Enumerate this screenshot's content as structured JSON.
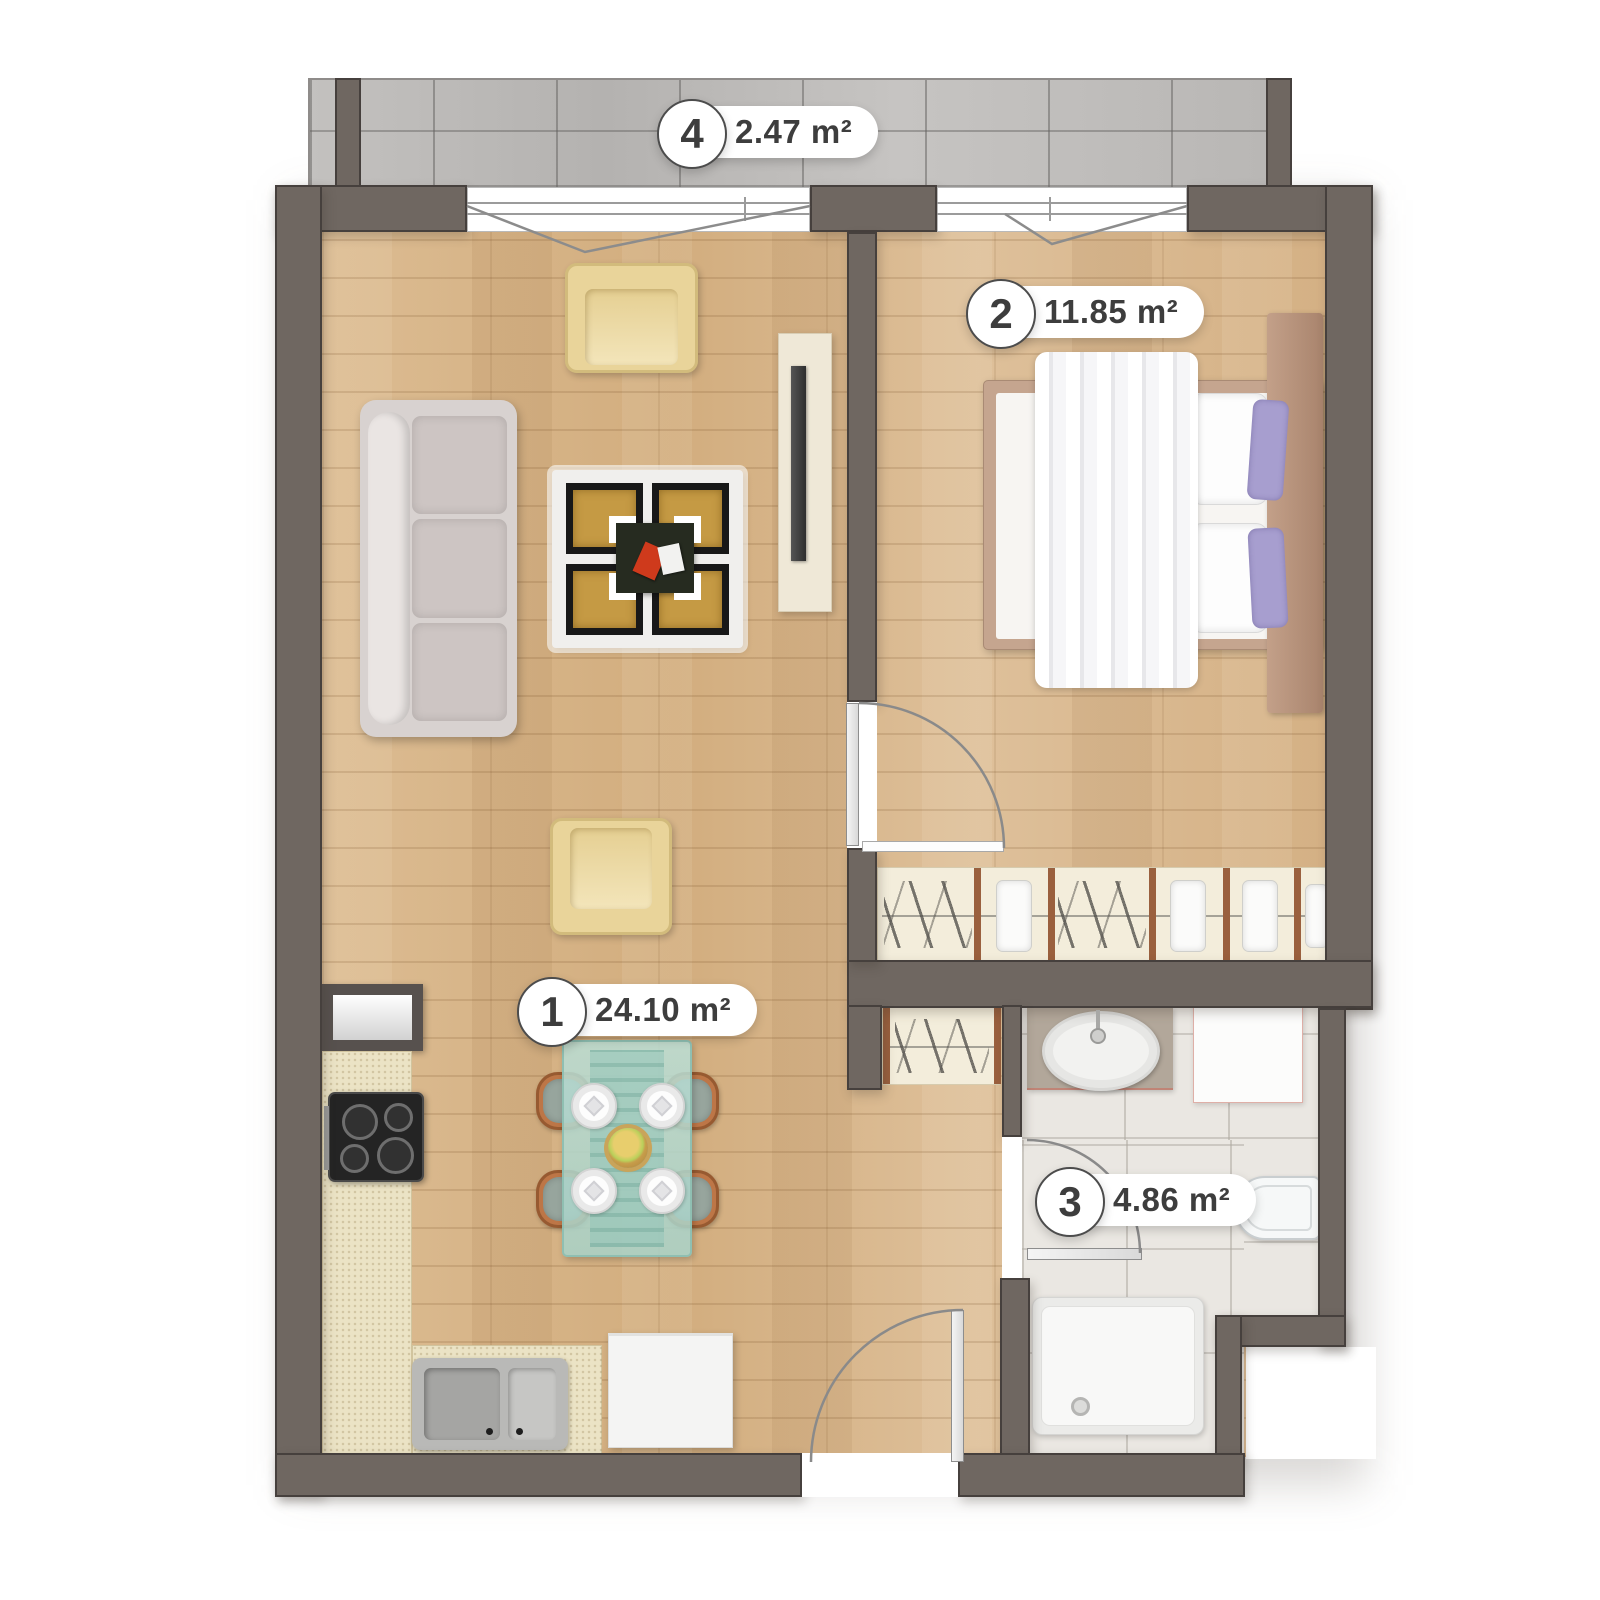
{
  "plan": {
    "type": "apartment-floor-plan",
    "rooms": [
      {
        "number": "1",
        "area": "24.10 m²"
      },
      {
        "number": "2",
        "area": "11.85 m²"
      },
      {
        "number": "3",
        "area": "4.86 m²"
      },
      {
        "number": "4",
        "area": "2.47 m²"
      }
    ],
    "colors": {
      "wall": "#6F6761",
      "wall_outline": "#46403D",
      "wood_floor": "#D6B489",
      "balcony_tile": "#BCBAB8",
      "bathroom_tile": "#EAE7E2",
      "closet_fill": "#F3EDDB",
      "closet_divider": "#9A603E",
      "kitchen_counter": "#EBE3C5",
      "armchair": "#E9D49A",
      "sofa": "#D8D2D0",
      "rug_square": "#C59A44",
      "dining_glass": "#B3D8CF",
      "bed_frame": "#C5A58F",
      "pillow_accent": "#A79ECF",
      "label_text": "#3D3D3D"
    }
  }
}
